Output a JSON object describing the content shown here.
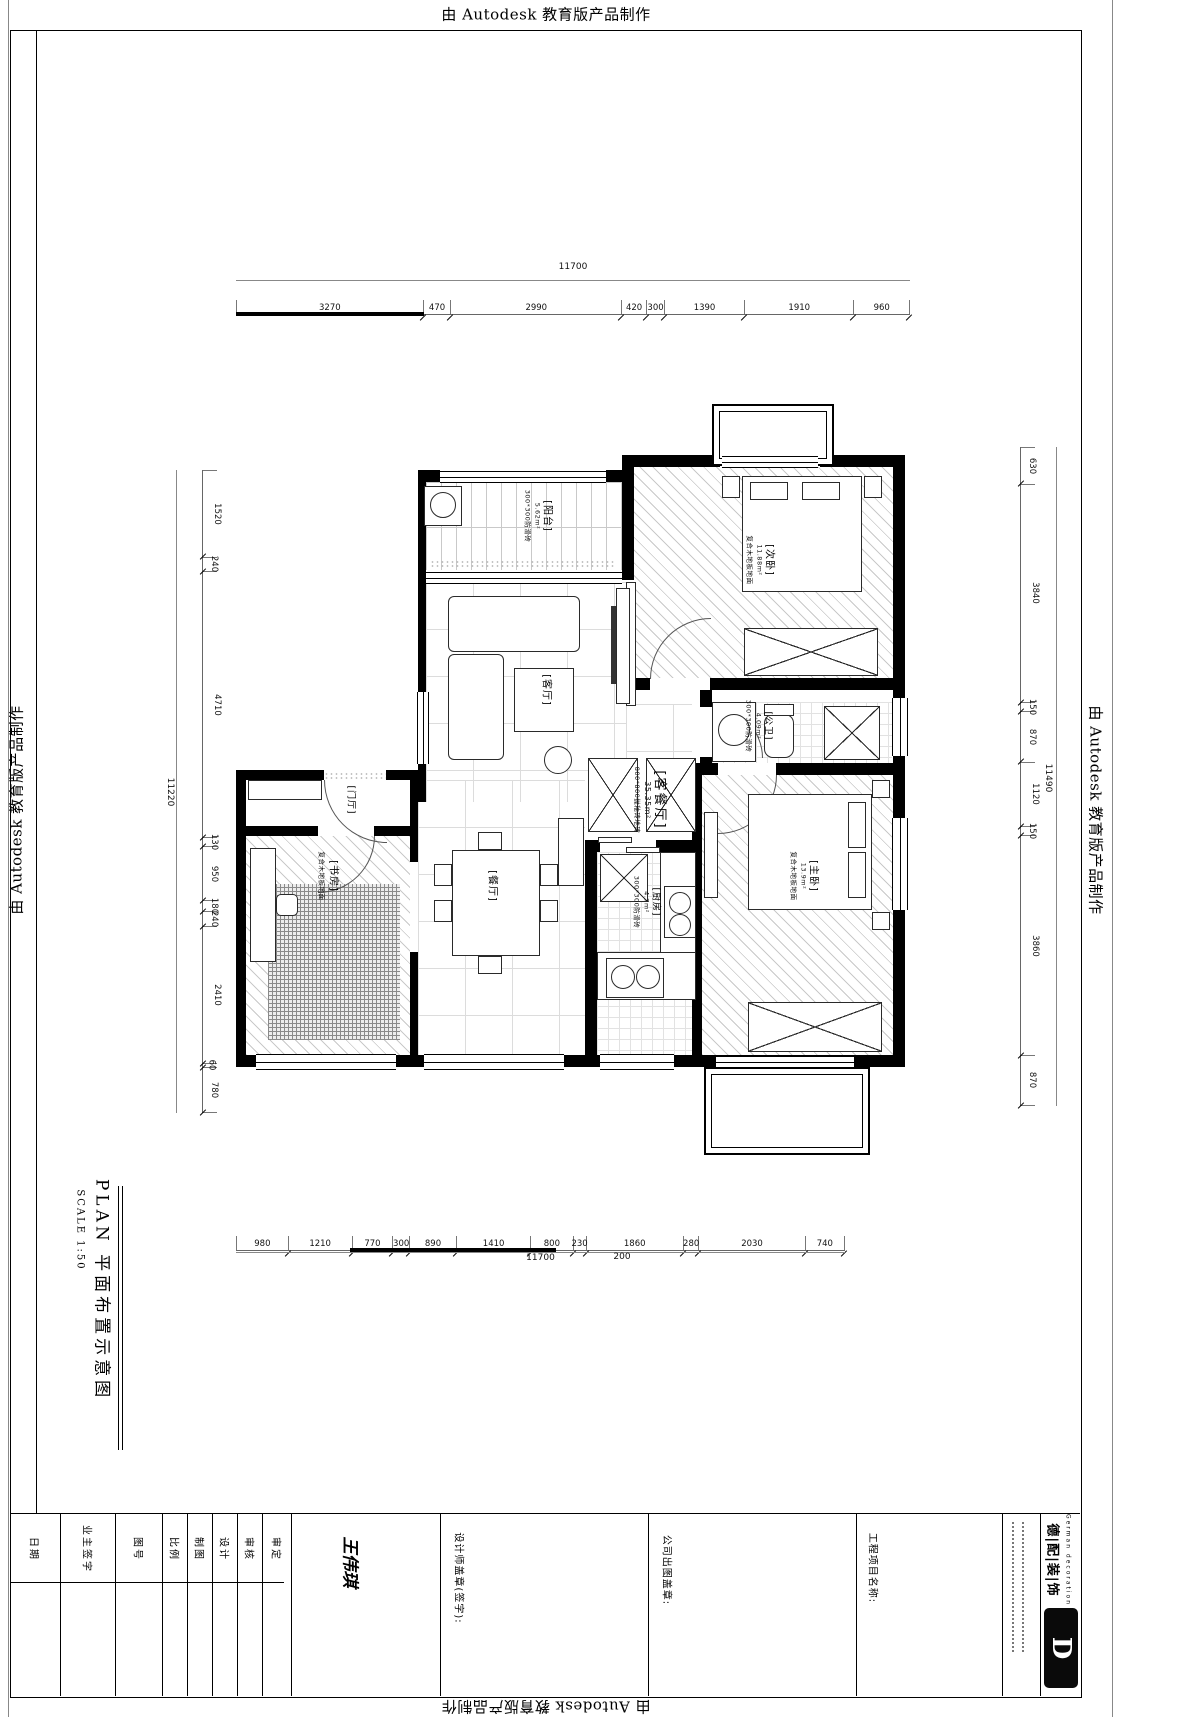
{
  "watermark": {
    "text": "由 Autodesk 教育版产品制作"
  },
  "side_title": {
    "main": "PLAN  平面布置示意图",
    "scale": "SCALE  1:50"
  },
  "dims": {
    "top": {
      "total": "11700",
      "segments": [
        "3270",
        "470",
        "2990",
        "420",
        "300",
        "1390",
        "1910",
        "960"
      ]
    },
    "bottom": {
      "total": "11700",
      "segments": [
        "980",
        "1210",
        "770",
        "300",
        "890",
        "1410",
        "800",
        "230",
        "1860",
        "280",
        "2030",
        "740"
      ],
      "sub_label": "200"
    },
    "left": {
      "total": "11220",
      "segments": [
        "1520",
        "240",
        "4710",
        "130",
        "950",
        "180",
        "240",
        "2410",
        "60",
        "780"
      ]
    },
    "right": {
      "total": "11490",
      "segments": [
        "630",
        "3840",
        "150",
        "870",
        "1120",
        "150",
        "3860",
        "870"
      ]
    }
  },
  "rooms": {
    "balcony": {
      "name": "[阳台]",
      "area": "5.62m²",
      "floor": "300*300防滑砖"
    },
    "living": {
      "name": "[客厅]"
    },
    "living_dining": {
      "name": "[客餐厅]",
      "area": "35.35m²",
      "floor": "800*800抛釉砖地砖"
    },
    "bedroom2": {
      "name": "[次卧]",
      "area": "11.88m²",
      "floor": "复合木地板地面"
    },
    "bath": {
      "name": "[公卫]",
      "area": "4.09m²",
      "floor": "300*300防滑砖"
    },
    "foyer": {
      "name": "[门厅]"
    },
    "study": {
      "name": "[书房]",
      "floor": "复合木地板地面"
    },
    "dining": {
      "name": "[餐厅]"
    },
    "kitchen": {
      "name": "[厨房]",
      "area": "4.7m²",
      "floor": "300*300防滑砖"
    },
    "master": {
      "name": "[主卧]",
      "area": "13.9m²",
      "floor": "复合木地板地面"
    }
  },
  "titleblock": {
    "columns": [
      "日期",
      "业主签字",
      "图号",
      "比例",
      "制图",
      "设计",
      "审核",
      "审定"
    ],
    "signature": "王伟琪",
    "designer_stamp": "设计师盖章(签字):",
    "company_stamp": "公司出图盖章:",
    "project_label": "工程项目名称:",
    "brand": {
      "name": "德|配|装|饰",
      "sub": "German decoration",
      "logo_letter": "D"
    }
  },
  "colors": {
    "wall": "#000000",
    "dimline": "#666666",
    "hatch": "#c9c9c9"
  }
}
